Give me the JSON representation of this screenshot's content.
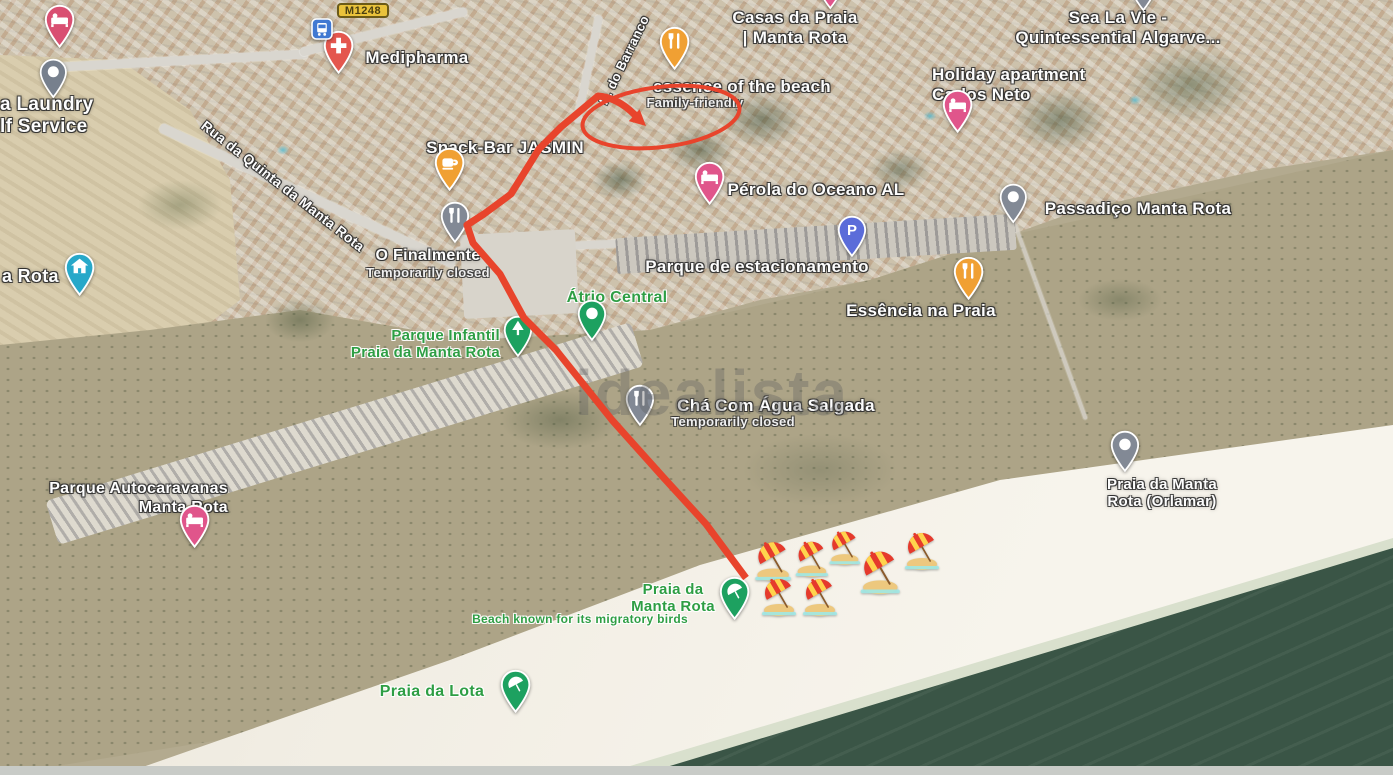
{
  "map": {
    "watermark": "idealista",
    "road_shield": {
      "label": "M1248"
    },
    "labels": [
      {
        "id": "casas-da-praia",
        "lines": [
          "Casas da Praia",
          "| Manta Rota"
        ],
        "x": 795,
        "y": 8,
        "size": 17,
        "style": "white",
        "click": true
      },
      {
        "id": "sea-la-vie",
        "lines": [
          "Sea La Vie -",
          "Quintessential Algarve..."
        ],
        "x": 1118,
        "y": 8,
        "size": 17,
        "style": "white",
        "click": true
      },
      {
        "id": "medipharma",
        "lines": [
          "Medipharma"
        ],
        "x": 417,
        "y": 48,
        "size": 17,
        "style": "white",
        "click": true
      },
      {
        "id": "laundry-self-service",
        "lines": [
          "a Laundry",
          "lf Service"
        ],
        "x": 0,
        "y": 94,
        "size": 19,
        "style": "white",
        "align": "left",
        "click": true
      },
      {
        "id": "holiday-apartment",
        "lines": [
          "Holiday apartment",
          "Carlos Neto"
        ],
        "x": 932,
        "y": 65,
        "size": 17,
        "style": "white",
        "align": "left",
        "click": true
      },
      {
        "id": "essence-of-the-beach",
        "lines": [
          "essence of the beach"
        ],
        "x": 742,
        "y": 77,
        "size": 17,
        "style": "white",
        "click": true
      },
      {
        "id": "family-friendly",
        "lines": [
          "Family-friendly"
        ],
        "x": 695,
        "y": 95,
        "size": 13,
        "style": "sub",
        "click": false
      },
      {
        "id": "snack-bar-jasmin",
        "lines": [
          "Snack-Bar JASMIN"
        ],
        "x": 505,
        "y": 138,
        "size": 17,
        "style": "white",
        "click": true
      },
      {
        "id": "perola-do-oceano",
        "lines": [
          "Pérola do Oceano AL"
        ],
        "x": 816,
        "y": 180,
        "size": 17,
        "style": "white",
        "click": true
      },
      {
        "id": "passadico-manta-rota",
        "lines": [
          "Passadiço Manta Rota"
        ],
        "x": 1138,
        "y": 199,
        "size": 17,
        "style": "white",
        "click": true
      },
      {
        "id": "o-finalmente",
        "lines": [
          "O Finalmente"
        ],
        "x": 428,
        "y": 247,
        "size": 16,
        "style": "white",
        "click": true
      },
      {
        "id": "o-finalmente-status",
        "lines": [
          "Temporarily closed"
        ],
        "x": 428,
        "y": 265,
        "size": 13,
        "style": "sub",
        "click": false
      },
      {
        "id": "parque-estacionamento",
        "lines": [
          "Parque de estacionamento"
        ],
        "x": 757,
        "y": 257,
        "size": 17,
        "style": "white",
        "click": true
      },
      {
        "id": "essencia-na-praia",
        "lines": [
          "Essência na Praia"
        ],
        "x": 921,
        "y": 301,
        "size": 17,
        "style": "white",
        "click": true
      },
      {
        "id": "atrio-central",
        "lines": [
          "Átrio Central"
        ],
        "x": 617,
        "y": 289,
        "size": 16,
        "style": "green",
        "click": true
      },
      {
        "id": "parque-infantil",
        "lines": [
          "Parque Infantil",
          "Praia da Manta Rota"
        ],
        "x": 500,
        "y": 327,
        "size": 15,
        "style": "green",
        "align": "right",
        "click": true
      },
      {
        "id": "cha-com-agua-salgada",
        "lines": [
          "Chá Com Água Salgada"
        ],
        "x": 776,
        "y": 396,
        "size": 17,
        "style": "white",
        "click": true
      },
      {
        "id": "cha-status",
        "lines": [
          "Temporarily closed"
        ],
        "x": 733,
        "y": 414,
        "size": 13,
        "style": "sub",
        "click": false
      },
      {
        "id": "rua-da-quinta",
        "lines": [
          "Rua da Quinta da Manta Rota"
        ],
        "x": 283,
        "y": 186,
        "size": 14,
        "style": "white",
        "rotate": 38,
        "click": false
      },
      {
        "id": "r-do-barranco",
        "lines": [
          "R. do Barranco"
        ],
        "x": 624,
        "y": 60,
        "size": 13,
        "style": "white",
        "rotate": -64,
        "click": false
      },
      {
        "id": "a-rota",
        "lines": [
          "a Rota"
        ],
        "x": 2,
        "y": 266,
        "size": 18,
        "style": "white",
        "align": "left",
        "click": true
      },
      {
        "id": "praia-orlamar",
        "lines": [
          "Praia da Manta",
          "Rota (Orlamar)"
        ],
        "x": 1162,
        "y": 476,
        "size": 15,
        "style": "white",
        "click": true
      },
      {
        "id": "parque-autocaravanas",
        "lines": [
          "Parque Autocaravanas",
          "Manta Rota"
        ],
        "x": 228,
        "y": 480,
        "size": 16,
        "style": "white",
        "align": "right",
        "click": true
      },
      {
        "id": "praia-da-manta-rota",
        "lines": [
          "Praia da",
          "Manta Rota"
        ],
        "x": 673,
        "y": 581,
        "size": 15,
        "style": "green",
        "click": true
      },
      {
        "id": "beach-migratory-birds",
        "lines": [
          "Beach known for its migratory birds"
        ],
        "x": 580,
        "y": 613,
        "size": 12,
        "style": "green",
        "click": false
      },
      {
        "id": "praia-da-lota",
        "lines": [
          "Praia da Lota"
        ],
        "x": 432,
        "y": 683,
        "size": 16,
        "style": "green",
        "click": true
      }
    ],
    "pins": [
      {
        "id": "lodging-topleft",
        "type": "bed",
        "color": "#d94f72",
        "x": 60,
        "y": 48,
        "s": 1.2
      },
      {
        "id": "laundry",
        "type": "dot",
        "color": "#77808d",
        "x": 53,
        "y": 99,
        "s": 1.1
      },
      {
        "id": "medipharma",
        "type": "plus",
        "color": "#e4564e",
        "x": 339,
        "y": 74,
        "s": 1.2
      },
      {
        "id": "bus-stop",
        "type": "bus",
        "color": "#4179d2",
        "x": 322,
        "y": 40,
        "s": 1.0
      },
      {
        "id": "restaurant-barranco",
        "type": "fork",
        "color": "#f0a033",
        "x": 675,
        "y": 70,
        "s": 1.2
      },
      {
        "id": "coffee-jasmin",
        "type": "coffee",
        "color": "#f0a033",
        "x": 450,
        "y": 191,
        "s": 1.2
      },
      {
        "id": "o-finalmente",
        "type": "fork",
        "color": "#828995",
        "x": 455,
        "y": 244,
        "s": 1.15
      },
      {
        "id": "perola-do-oceano",
        "type": "bed",
        "color": "#e0558b",
        "x": 710,
        "y": 205,
        "s": 1.2
      },
      {
        "id": "carlos-neto",
        "type": "bed",
        "color": "#e0558b",
        "x": 958,
        "y": 133,
        "s": 1.2
      },
      {
        "id": "passadico",
        "type": "dot",
        "color": "#828995",
        "x": 1013,
        "y": 224,
        "s": 1.1
      },
      {
        "id": "parking",
        "type": "P",
        "color": "#5b6cd9",
        "x": 852,
        "y": 258,
        "s": 1.15
      },
      {
        "id": "essencia-na-praia",
        "type": "fork",
        "color": "#f0a033",
        "x": 969,
        "y": 300,
        "s": 1.2
      },
      {
        "id": "atrio-central",
        "type": "dot",
        "color": "#1da160",
        "x": 592,
        "y": 342,
        "s": 1.15
      },
      {
        "id": "parque-infantil",
        "type": "tree",
        "color": "#1da160",
        "x": 518,
        "y": 358,
        "s": 1.15
      },
      {
        "id": "cha-com-agua",
        "type": "fork",
        "color": "#828995",
        "x": 640,
        "y": 427,
        "s": 1.15
      },
      {
        "id": "praia-orlamar",
        "type": "dot",
        "color": "#828995",
        "x": 1125,
        "y": 473,
        "s": 1.15
      },
      {
        "id": "autocaravanas",
        "type": "bed",
        "color": "#e0558b",
        "x": 195,
        "y": 548,
        "s": 1.2
      },
      {
        "id": "praia-manta-rota",
        "type": "umbrella",
        "color": "#1da160",
        "x": 735,
        "y": 620,
        "s": 1.2
      },
      {
        "id": "praia-da-lota",
        "type": "umbrella",
        "color": "#1da160",
        "x": 516,
        "y": 713,
        "s": 1.2
      },
      {
        "id": "a-rota-town",
        "type": "home",
        "color": "#27a8c9",
        "x": 80,
        "y": 296,
        "s": 1.2
      },
      {
        "id": "cut-pin-top-center",
        "type": "dot",
        "color": "#e0558b",
        "x": 830,
        "y": 10,
        "s": 1.1
      },
      {
        "id": "cut-pin-top-right",
        "type": "dot",
        "color": "#828995",
        "x": 1143,
        "y": 12,
        "s": 1.1
      }
    ],
    "route_annotation": {
      "color": "#e8442c",
      "route": [
        [
          598,
          96
        ],
        [
          561,
          127
        ],
        [
          539,
          149
        ],
        [
          511,
          194
        ],
        [
          484,
          214
        ],
        [
          467,
          225
        ],
        [
          473,
          243
        ],
        [
          500,
          274
        ],
        [
          524,
          318
        ],
        [
          556,
          350
        ],
        [
          612,
          420
        ],
        [
          663,
          477
        ],
        [
          706,
          524
        ],
        [
          746,
          578
        ]
      ],
      "arrow_shaft": "M598,96 C612,97 625,105 635,115",
      "arrow_head": "646,126 628.8,121.1 639.6,109.3",
      "ellipse": {
        "cx": 661,
        "cy": 117,
        "rx": 79,
        "ry": 30,
        "rotate": -7
      }
    },
    "umbrellas": [
      {
        "x": 773,
        "y": 561,
        "s": 1.05
      },
      {
        "x": 812,
        "y": 559,
        "s": 0.95
      },
      {
        "x": 845,
        "y": 548,
        "s": 0.9
      },
      {
        "x": 880,
        "y": 572,
        "s": 1.15
      },
      {
        "x": 922,
        "y": 551,
        "s": 1.0
      },
      {
        "x": 779,
        "y": 597,
        "s": 1.0
      },
      {
        "x": 820,
        "y": 597,
        "s": 1.0
      }
    ]
  }
}
